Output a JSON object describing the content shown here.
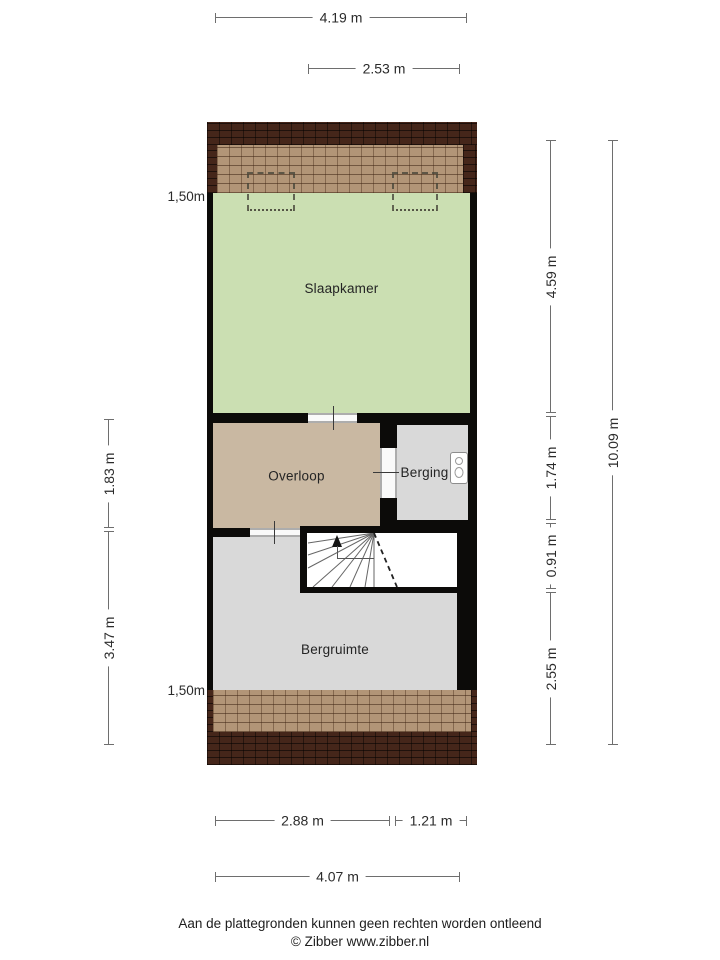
{
  "plan": {
    "rooms": {
      "slaapkamer": {
        "label": "Slaapkamer"
      },
      "overloop": {
        "label": "Overloop"
      },
      "berging": {
        "label": "Berging"
      },
      "bergruimte": {
        "label": "Bergruimte"
      }
    },
    "features": {
      "stairs": "winder staircase with up arrow and dashed headroom line",
      "roof_windows": 2,
      "boiler_unit": "wall-mounted unit in Berging"
    }
  },
  "dims": {
    "top": [
      {
        "label": "4.19 m"
      },
      {
        "label": "2.53 m"
      }
    ],
    "bottom": [
      {
        "label": "2.88 m"
      },
      {
        "label": "1.21 m"
      },
      {
        "label": "4.07 m"
      }
    ],
    "left": {
      "inner": {
        "label": "8.25 m",
        "top_mark": "1,50m",
        "bottom_mark": "1,50m"
      },
      "outer": [
        {
          "label": "1.83 m"
        },
        {
          "label": "3.47 m"
        }
      ]
    },
    "right": {
      "inner": [
        {
          "label": "4.59 m"
        },
        {
          "label": "1.74 m"
        },
        {
          "label": "0.91 m"
        },
        {
          "label": "2.55 m"
        }
      ],
      "outer": {
        "label": "10.09 m"
      }
    }
  },
  "footer": {
    "disclaimer": "Aan de plattegronden kunnen geen rechten worden ontleend",
    "copyright": "© Zibber www.zibber.nl"
  },
  "colors": {
    "room_slaapkamer": "#cbdfb2",
    "room_overloop": "#c9b8a2",
    "room_gray": "#d9d9d9",
    "roof_tiles_light": "#b29577",
    "roof_tiles_dark": "#45261a",
    "walls": "#0c0b09"
  }
}
